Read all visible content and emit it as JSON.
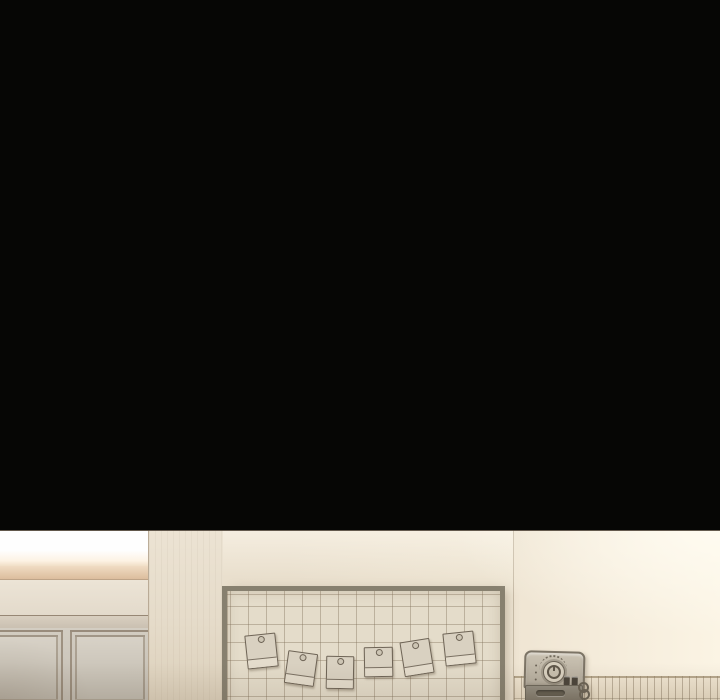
{
  "scene": {
    "kind": "webtoon-interior-panel",
    "description": "Black void above a dimly lit room: cabinet doors at left, wire-grid memo board with six pinned notes, bright wall seam, slatted wainscot and a small dial appliance at right",
    "notes": [
      {
        "left": 246,
        "top": 104,
        "width": 29,
        "height": 32,
        "rotation": -6
      },
      {
        "left": 286,
        "top": 122,
        "width": 28,
        "height": 31,
        "rotation": 8
      },
      {
        "left": 326,
        "top": 126,
        "width": 26,
        "height": 31,
        "rotation": 1
      },
      {
        "left": 364,
        "top": 117,
        "width": 27,
        "height": 28,
        "rotation": -1
      },
      {
        "left": 402,
        "top": 110,
        "width": 28,
        "height": 33,
        "rotation": -9
      },
      {
        "left": 444,
        "top": 102,
        "width": 29,
        "height": 31,
        "rotation": -6
      }
    ],
    "board": {
      "grid_cell_px": 18,
      "note_count": 6
    },
    "machine": {
      "leds": 3,
      "buttons": 2,
      "cord_loops": 2
    }
  },
  "colors": {
    "black": "#060605",
    "edge_line": "#4a4034",
    "light_band": "#fefefe",
    "tan_band_top": "#f0dcc3",
    "tan_band_bottom": "#dcbd9d",
    "left_wall": "#eae2d3",
    "rail_top": "#d9cfc0",
    "rail_bottom": "#c9bfb0",
    "panel_top": "#d8d2c7",
    "panel_bottom": "#bfb9ad",
    "mid_wall_top": "#ece3d3",
    "mid_wall_bottom": "#dcd0bb",
    "wall_mid": "#e8decc",
    "right_wall_l": "#efe5d3",
    "wall_bright": "#fbf4e4",
    "board_frame": "#87806f",
    "board_face": "#e4dcca",
    "note_face": "#d9d1c1",
    "note_caption": "#e4dccc",
    "note_line": "#6e6456",
    "wainscot_top": "#efe4d0",
    "wainscot_bottom": "#e7dbc4",
    "machine_edge": "#7c7466",
    "machine_top1": "#cac2b2",
    "machine_top2": "#b2aa9b",
    "machine_bottom1": "#948e81",
    "machine_bottom2": "#7d7668",
    "dial_face": "#d8d0bf",
    "dial_dark": "#5f574a",
    "button": "#4b453b",
    "slot": "#645e51"
  }
}
